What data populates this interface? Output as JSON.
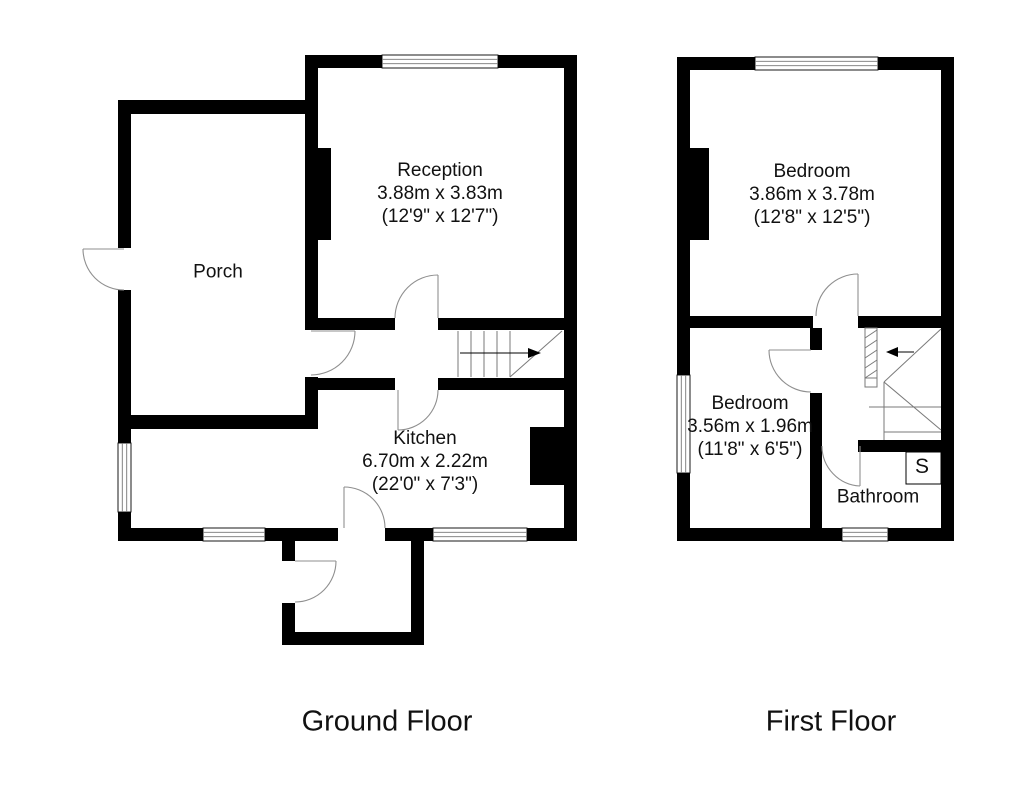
{
  "ground_floor": {
    "title": "Ground Floor",
    "rooms": {
      "porch": {
        "name": "Porch"
      },
      "reception": {
        "name": "Reception",
        "metric": "3.88m x 3.83m",
        "imperial": "(12'9\" x 12'7\")"
      },
      "kitchen": {
        "name": "Kitchen",
        "metric": "6.70m x 2.22m",
        "imperial": "(22'0\" x 7'3\")"
      }
    }
  },
  "first_floor": {
    "title": "First Floor",
    "rooms": {
      "bedroom1": {
        "name": "Bedroom",
        "metric": "3.86m x 3.78m",
        "imperial": "(12'8\" x 12'5\")"
      },
      "bedroom2": {
        "name": "Bedroom",
        "metric": "3.56m x 1.96m",
        "imperial": "(11'8\" x 6'5\")"
      },
      "bathroom": {
        "name": "Bathroom"
      },
      "storage": {
        "name": "S"
      }
    }
  },
  "colors": {
    "wall": "#000000",
    "background": "#ffffff",
    "door_arc": "#8f8f8f"
  }
}
